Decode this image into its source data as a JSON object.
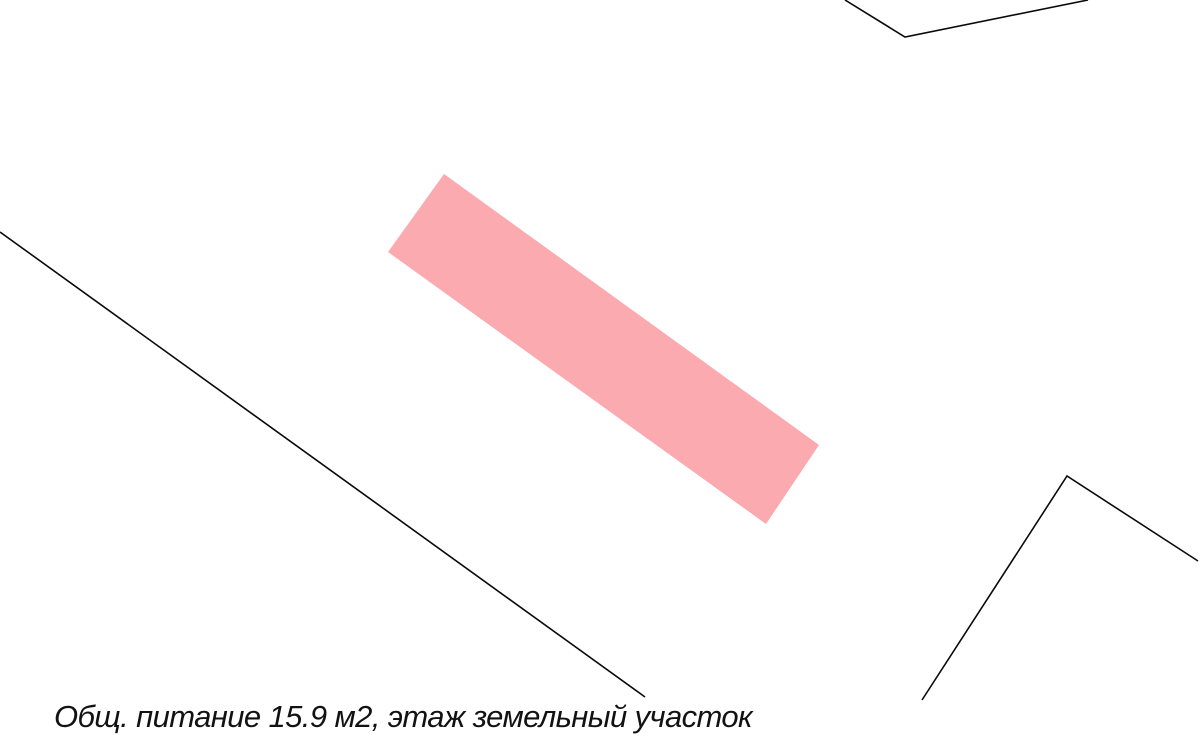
{
  "map": {
    "background_color": "#ffffff",
    "colors": {
      "building_fill": "#fbaab0",
      "line_stroke": "#0a0a0a"
    },
    "label_text": "Общ. питание 15.9 м2, этаж земельный участок",
    "shapes": {
      "building_polygon": "444,174 819,445 766,524 388,252",
      "parcel_boundary_line": "0,232 645,697",
      "northeast_boundary": "845,0 905,37 1088,0",
      "southeast_boundary": "922,700 1067,476 1198,561"
    }
  }
}
